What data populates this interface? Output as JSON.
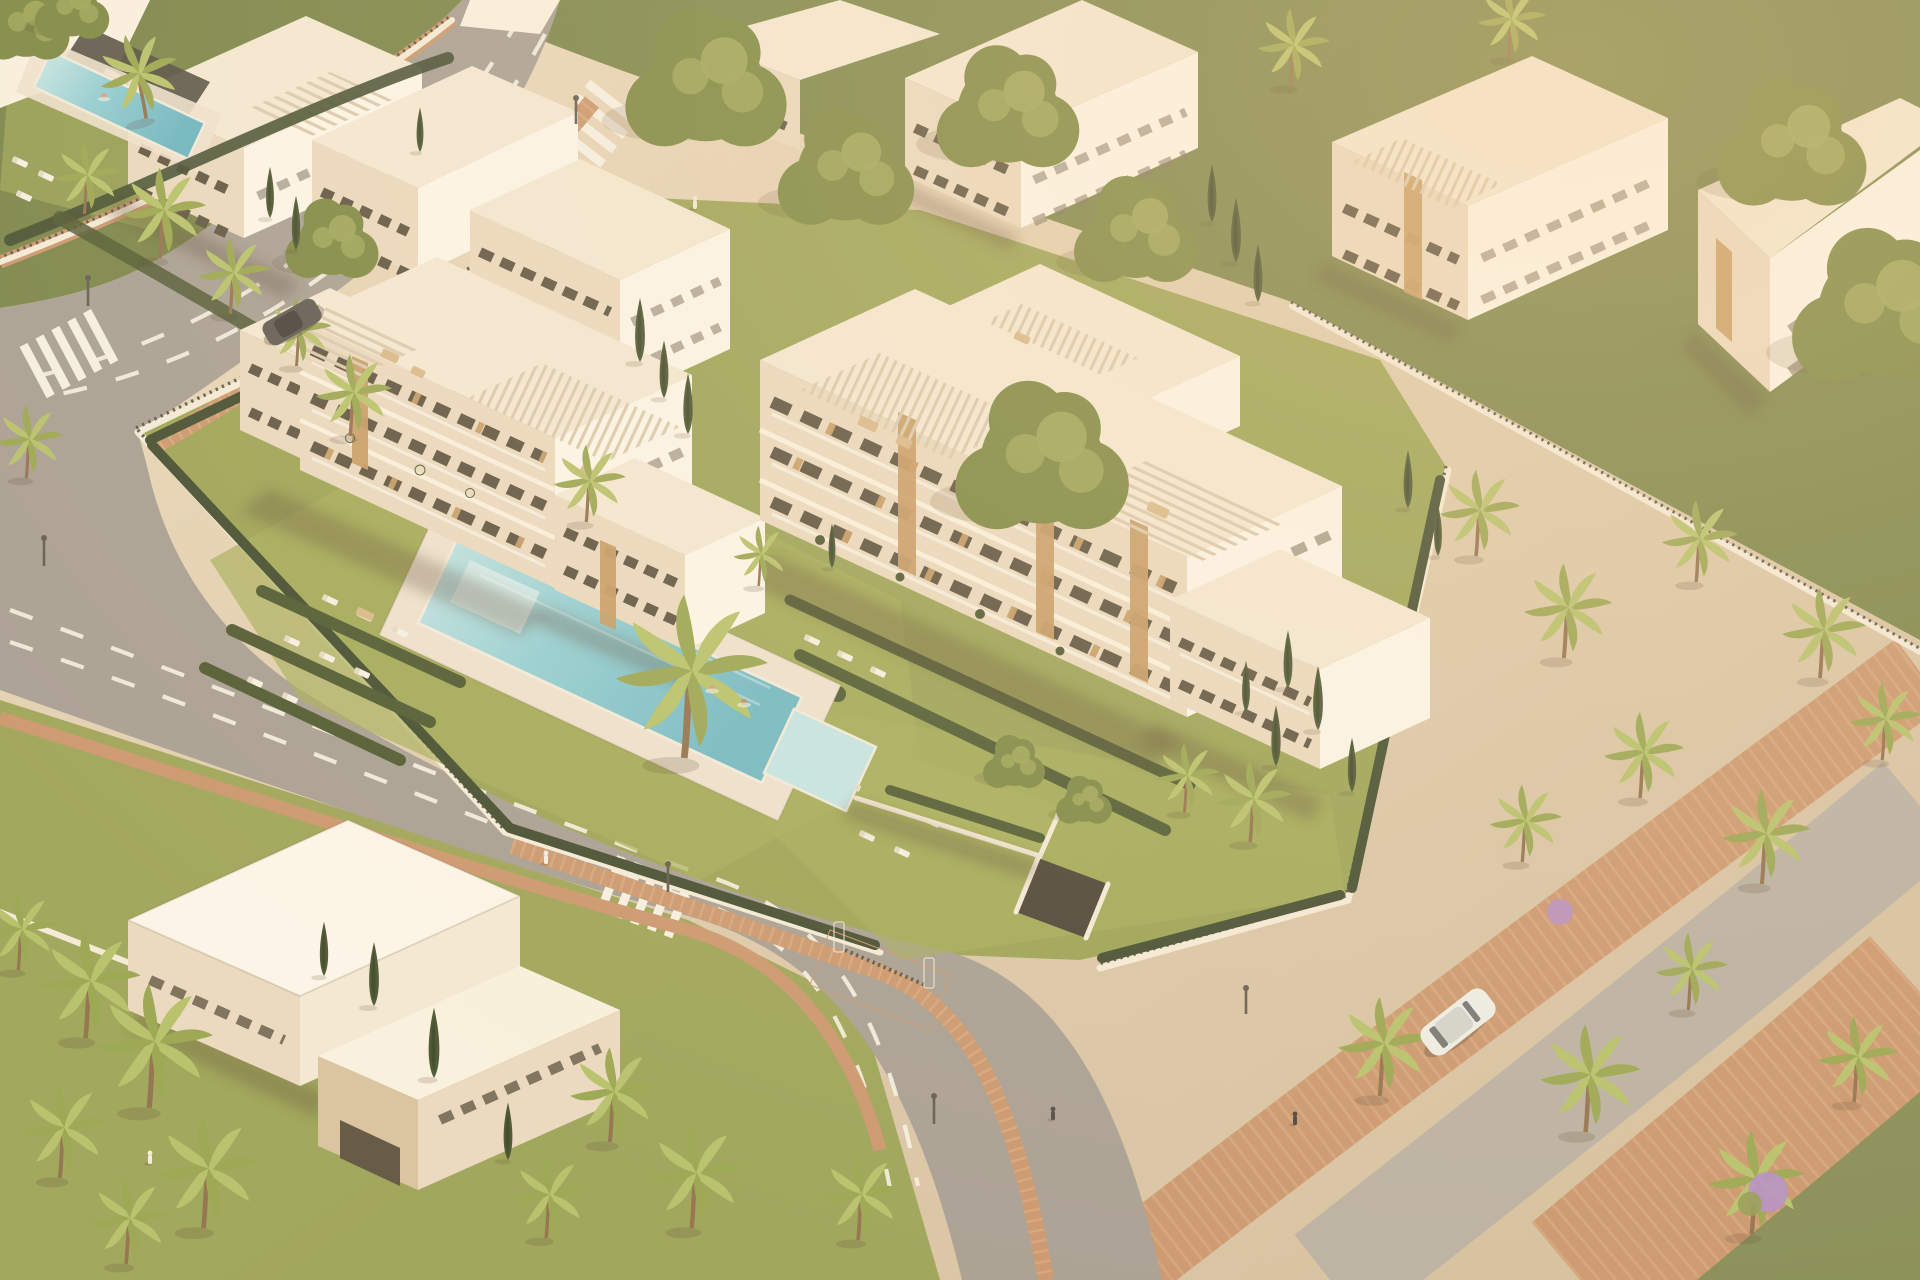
{
  "scene": {
    "subject": "Aerial 3D architectural render of a modern white apartment complex with communal pool, landscaped gardens, palm trees, perimeter fences, curving streets and brick promenades at golden hour",
    "elements": [
      "main-left-apartment-building",
      "main-right-apartment-building",
      "communal-pool",
      "kids-pool",
      "pool-deck",
      "sun-loungers",
      "garden-hedges",
      "large-palm-tree",
      "top-left-complex",
      "lap-pool",
      "dark-pergola",
      "top-right-buildings",
      "villa-bottom-left",
      "perimeter-wall-fence",
      "curving-road",
      "crosswalks",
      "brick-sidewalks",
      "promenade-paths",
      "garage-entrance",
      "entrance-gate",
      "white-car",
      "dark-car",
      "pedestrians",
      "swimmers",
      "cypress-trees",
      "leafy-trees",
      "purple-bushes",
      "street-lamps"
    ],
    "lighting": "warm low sun from upper right, soft shadows toward lower left"
  },
  "palette": {
    "ground": "#ddcbae",
    "ground2": "#e7d7bc",
    "lawn": "#95a050",
    "lawn_bright": "#a3ad58",
    "lawn_shade": "#6d7c3e",
    "hedge": "#46542c",
    "hedge_dark": "#39462a",
    "tree": "#77853f",
    "tree_light": "#9aa557",
    "palm": "#95a44d",
    "palm_light": "#b3c168",
    "cypress": "#3f4e2b",
    "road": "#a49d94",
    "marking": "#f7f3e7",
    "brick": "#c9946b",
    "brick_light": "#dcae85",
    "path_grey": "#b7afa3",
    "building": "#faf3e4",
    "roof": "#f4ead7",
    "roof_bright": "#fdf8ee",
    "facade": "#eadbc2",
    "facade_shade": "#d9c3a1",
    "window": "#564e3e",
    "glass": "#7b7260",
    "wood": "#c49a63",
    "wall": "#f4ecdc",
    "fence": "#53524a",
    "pool": "#8ecfd8",
    "pool_light": "#c2e7e9",
    "pool_deep": "#63b4c4",
    "deck": "#eee3d2",
    "shadow": "rgba(86,66,45,0.30)",
    "pergola_dark": "#4a463e",
    "trunk": "#8d6c49",
    "car_white": "#eef0ec",
    "car_dark": "#55544f",
    "accent_purple": "#b18bc9"
  }
}
